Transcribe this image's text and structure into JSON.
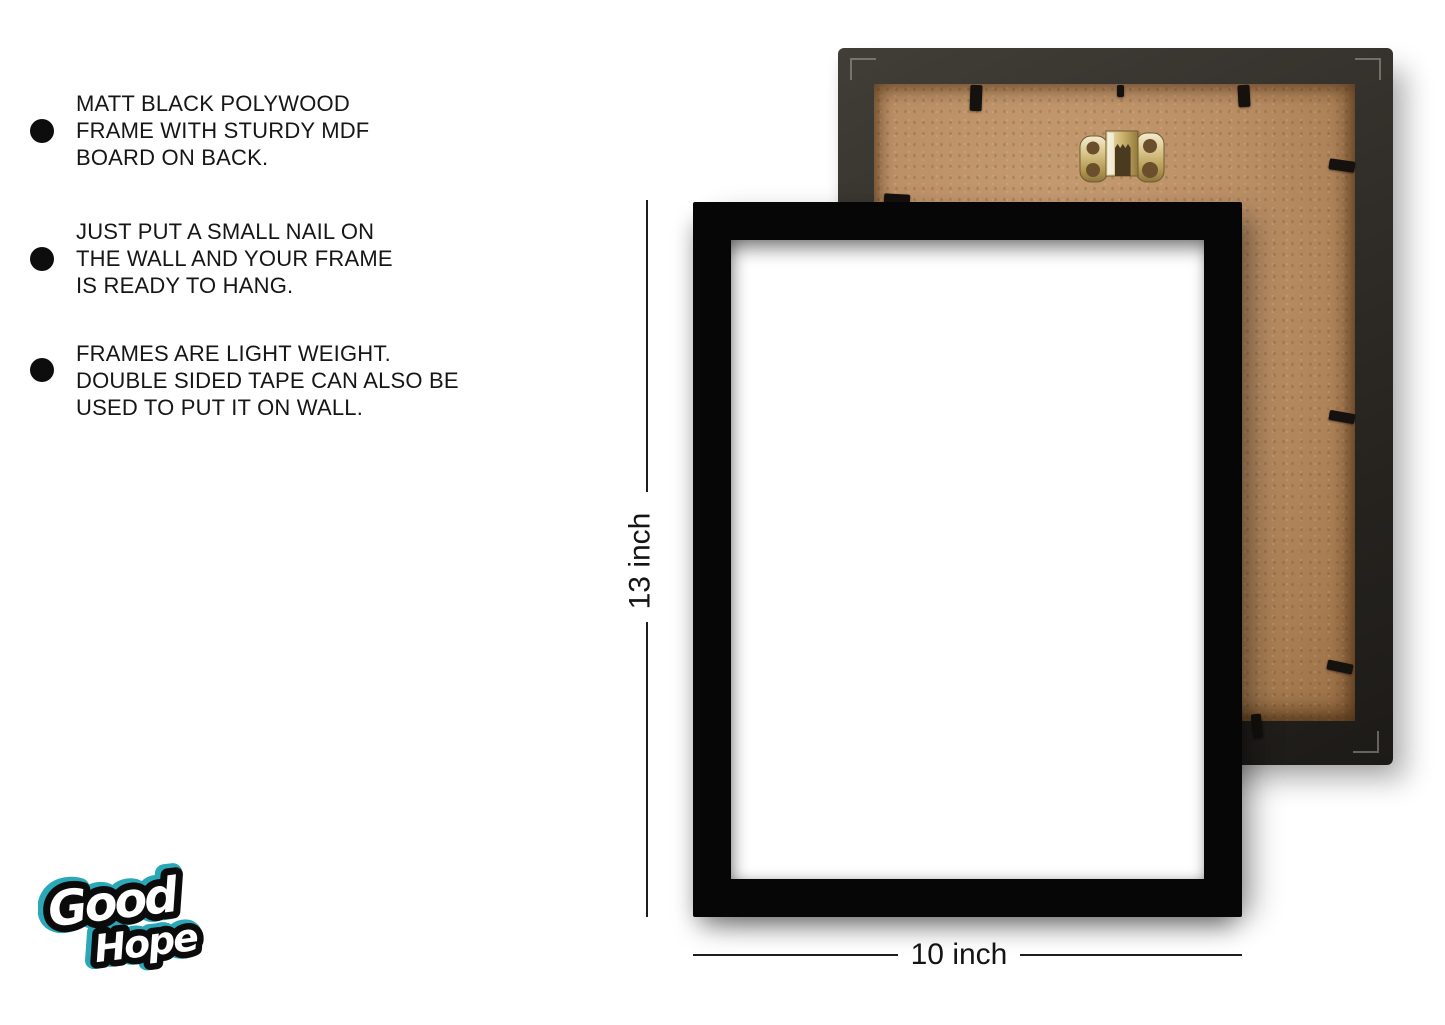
{
  "features": [
    {
      "lines": [
        "MATT BLACK POLYWOOD",
        "FRAME WITH STURDY MDF",
        "BOARD ON BACK."
      ]
    },
    {
      "lines": [
        "JUST PUT A SMALL NAIL ON",
        "THE WALL AND YOUR FRAME",
        "IS READY TO HANG."
      ]
    },
    {
      "lines": [
        "FRAMES ARE LIGHT WEIGHT.",
        "DOUBLE SIDED TAPE CAN ALSO BE",
        "USED TO PUT IT ON WALL."
      ]
    }
  ],
  "dimensions": {
    "height_label": "13 inch",
    "width_label": "10 inch"
  },
  "brand": {
    "word1": "Good",
    "word2": "Hope"
  },
  "icons": {
    "bullet": "filled-circle",
    "hanging_hook": "brass-sawtooth-hanger",
    "retainer_clip": "black-tab",
    "miter_mark": "corner-l-mark"
  },
  "colors": {
    "background": "#ffffff",
    "text": "#161616",
    "frame_black": "#060606",
    "back_frame_moulding": "#2e2b26",
    "mdf_board": "#ba8f66",
    "hook_gold": "#d8c48c",
    "logo_accent": "#2aa8b8"
  }
}
